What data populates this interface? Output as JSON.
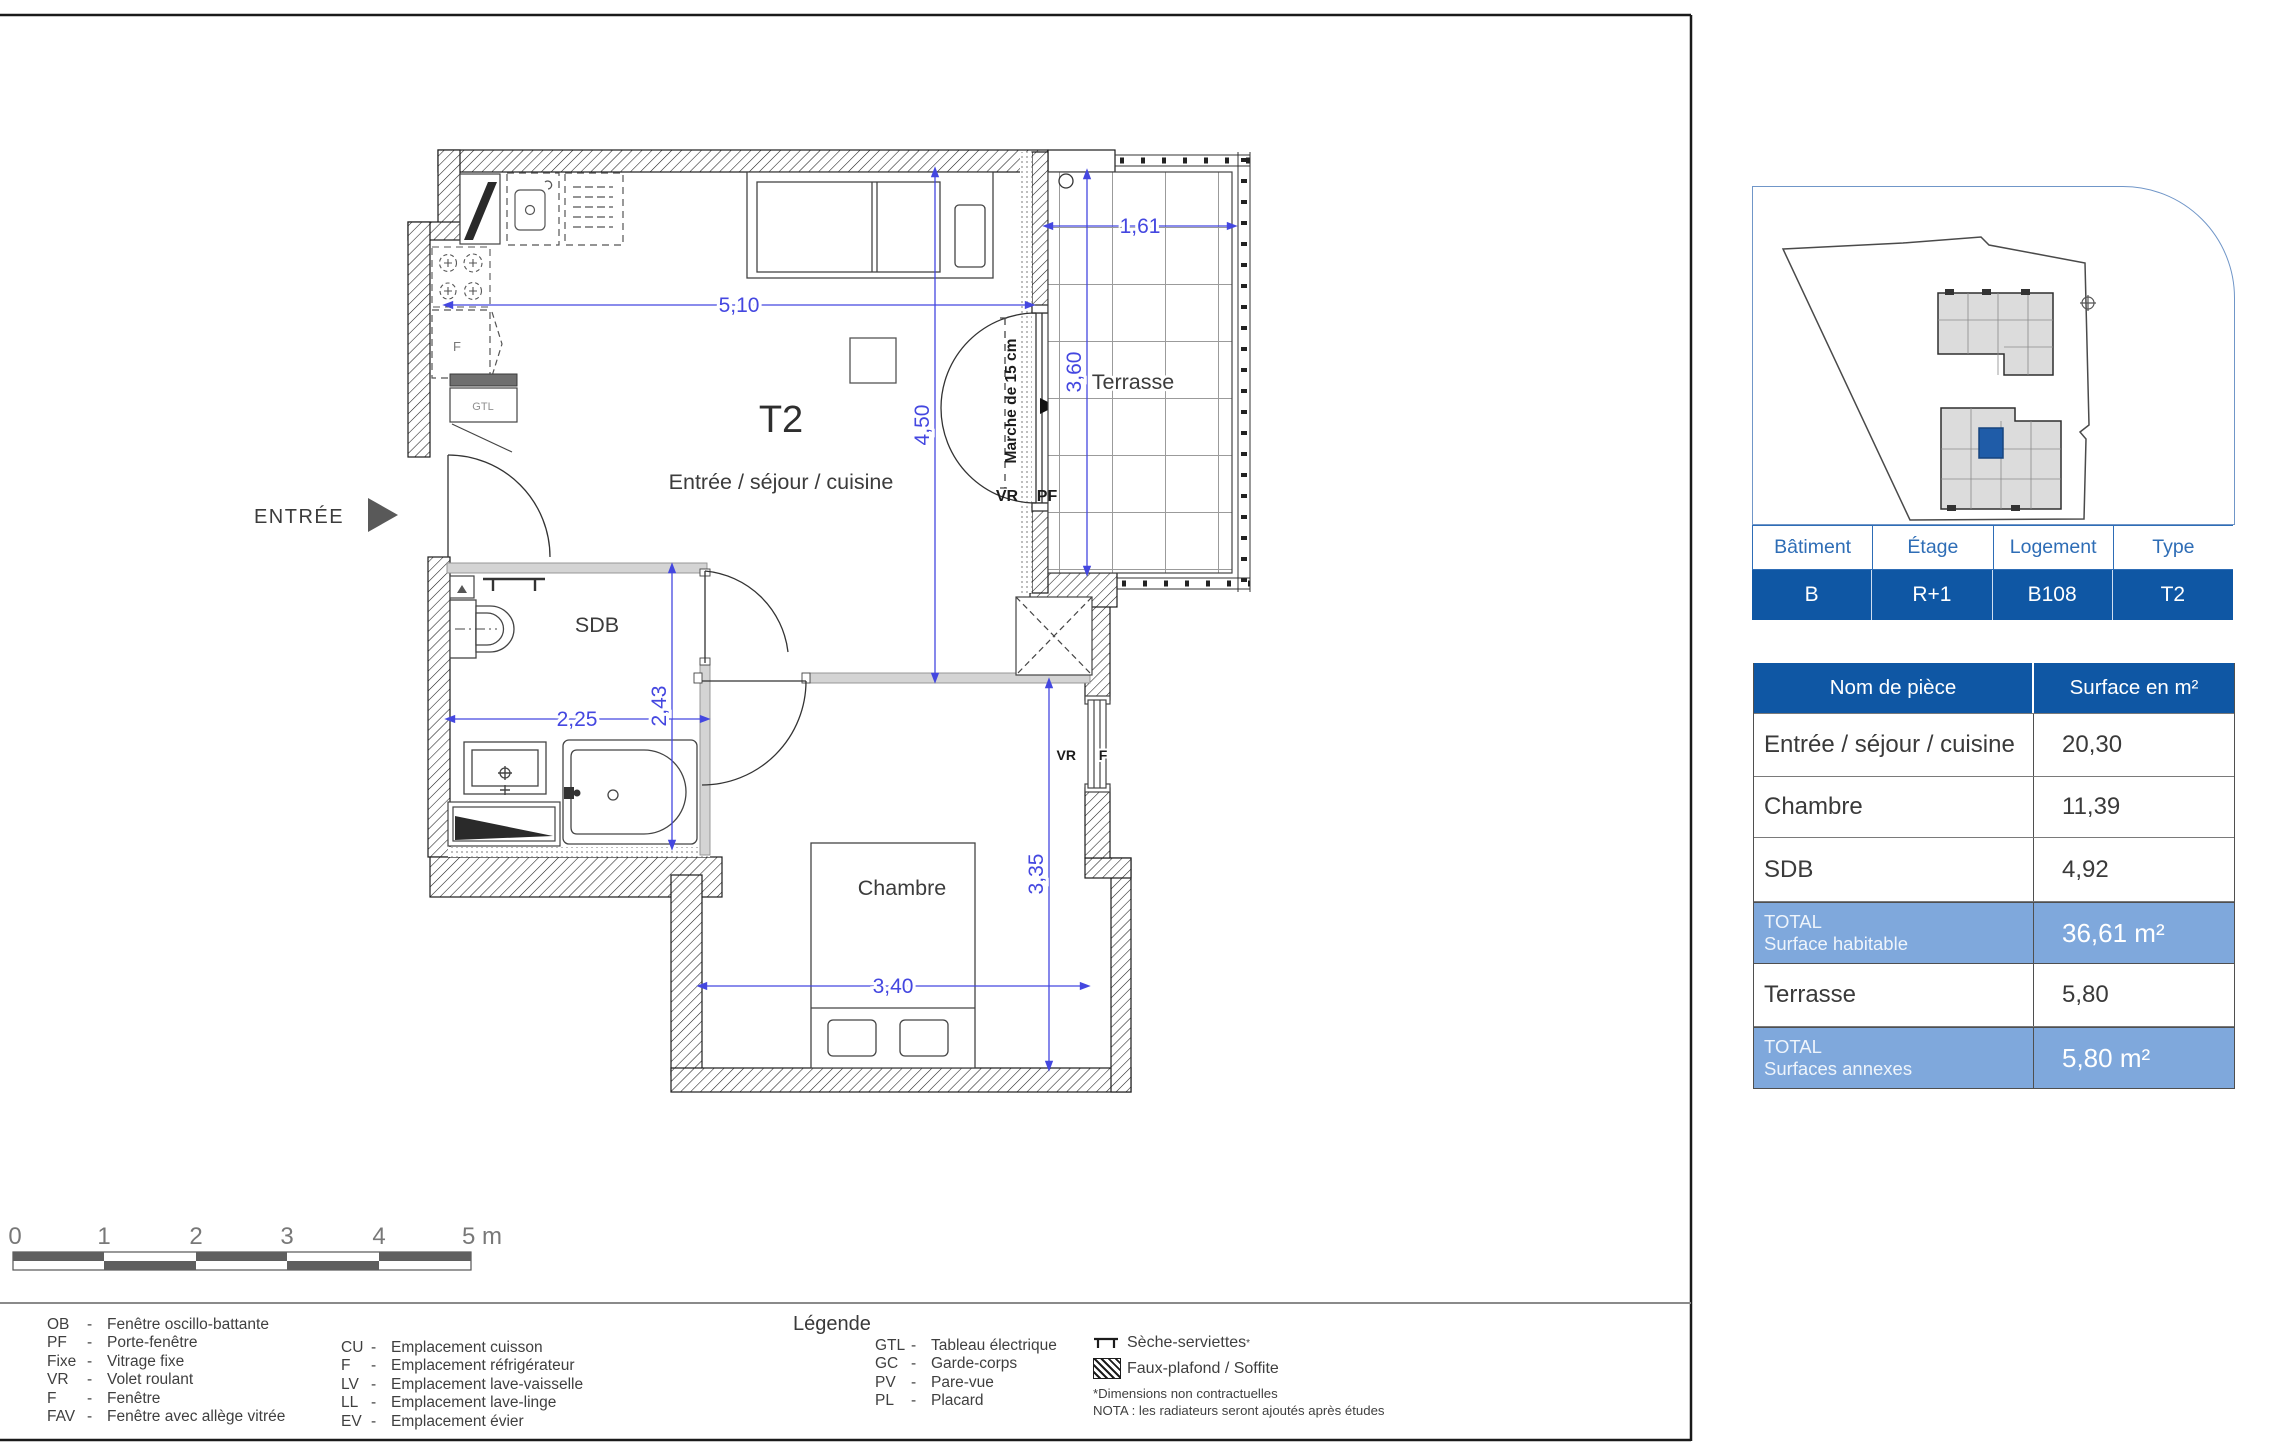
{
  "plan": {
    "type_label": "T2",
    "entry": "ENTRÉE",
    "step_note": "Marche de 15 cm",
    "gtl": "GTL",
    "fridge": "F",
    "rooms": {
      "living": "Entrée / séjour / cuisine",
      "bathroom": "SDB",
      "bedroom": "Chambre",
      "terrace": "Terrasse"
    },
    "openings": {
      "vr": "VR",
      "pf": "PF",
      "f": "F"
    },
    "dims": {
      "living_width": "5,10",
      "living_height": "4,50",
      "terrace_width": "1,61",
      "terrace_height": "3,60",
      "bathroom_width": "2,25",
      "bathroom_height": "2,43",
      "bedroom_width": "3,40",
      "bedroom_height": "3,35"
    }
  },
  "scale_bar": {
    "t0": "0",
    "t1": "1",
    "t2": "2",
    "t3": "3",
    "t4": "4",
    "t5": "5 m"
  },
  "legend": {
    "title": "Légende",
    "col1": [
      {
        "abbr": "OB",
        "dash": "-",
        "desc": "Fenêtre oscillo-battante"
      },
      {
        "abbr": "PF",
        "dash": "-",
        "desc": "Porte-fenêtre"
      },
      {
        "abbr": "Fixe",
        "dash": "-",
        "desc": "Vitrage fixe"
      },
      {
        "abbr": "VR",
        "dash": "-",
        "desc": "Volet roulant"
      },
      {
        "abbr": "F",
        "dash": "-",
        "desc": "Fenêtre"
      },
      {
        "abbr": "FAV",
        "dash": "-",
        "desc": "Fenêtre avec allège vitrée"
      }
    ],
    "col2": [
      {
        "abbr": "CU",
        "dash": "-",
        "desc": "Emplacement cuisson"
      },
      {
        "abbr": "F",
        "dash": "-",
        "desc": "Emplacement réfrigérateur"
      },
      {
        "abbr": "LV",
        "dash": "-",
        "desc": "Emplacement lave-vaisselle"
      },
      {
        "abbr": "LL",
        "dash": "-",
        "desc": "Emplacement lave-linge"
      },
      {
        "abbr": "EV",
        "dash": "-",
        "desc": "Emplacement évier"
      }
    ],
    "col3": [
      {
        "abbr": "GTL",
        "dash": "-",
        "desc": "Tableau électrique"
      },
      {
        "abbr": "GC",
        "dash": "-",
        "desc": "Garde-corps"
      },
      {
        "abbr": "PV",
        "dash": "-",
        "desc": "Pare-vue"
      },
      {
        "abbr": "PL",
        "dash": "-",
        "desc": "Placard"
      }
    ],
    "icon_items": [
      {
        "icon": "towel-dryer",
        "label": "Sèche-serviettes",
        "sup": "*"
      },
      {
        "icon": "hatched-square",
        "label": "Faux-plafond / Soffite",
        "sup": ""
      }
    ],
    "note1": "*Dimensions non contractuelles",
    "note2": "NOTA : les radiateurs seront ajoutés après études"
  },
  "unit_table": {
    "headers": [
      "Bâtiment",
      "Étage",
      "Logement",
      "Type"
    ],
    "values": [
      "B",
      "R+1",
      "B108",
      "T2"
    ]
  },
  "surface_table": {
    "col_room": "Nom de pièce",
    "col_surface": "Surface en m²",
    "rows": [
      {
        "room": "Entrée / séjour / cuisine",
        "surface": "20,30"
      },
      {
        "room": "Chambre",
        "surface": "11,39"
      },
      {
        "room": "SDB",
        "surface": "4,92"
      }
    ],
    "total_habitable": {
      "line1": "TOTAL",
      "line2": "Surface habitable",
      "value": "36,61 m²"
    },
    "terrace_row": {
      "room": "Terrasse",
      "surface": "5,80"
    },
    "total_annexes": {
      "line1": "TOTAL",
      "line2": "Surfaces annexes",
      "value": "5,80 m²"
    }
  },
  "colors": {
    "dark_blue": "#0f57a4",
    "mid_blue": "#7fa8dc",
    "dim_blue": "#4447e0",
    "unit_blue": "#1f5ca8"
  }
}
